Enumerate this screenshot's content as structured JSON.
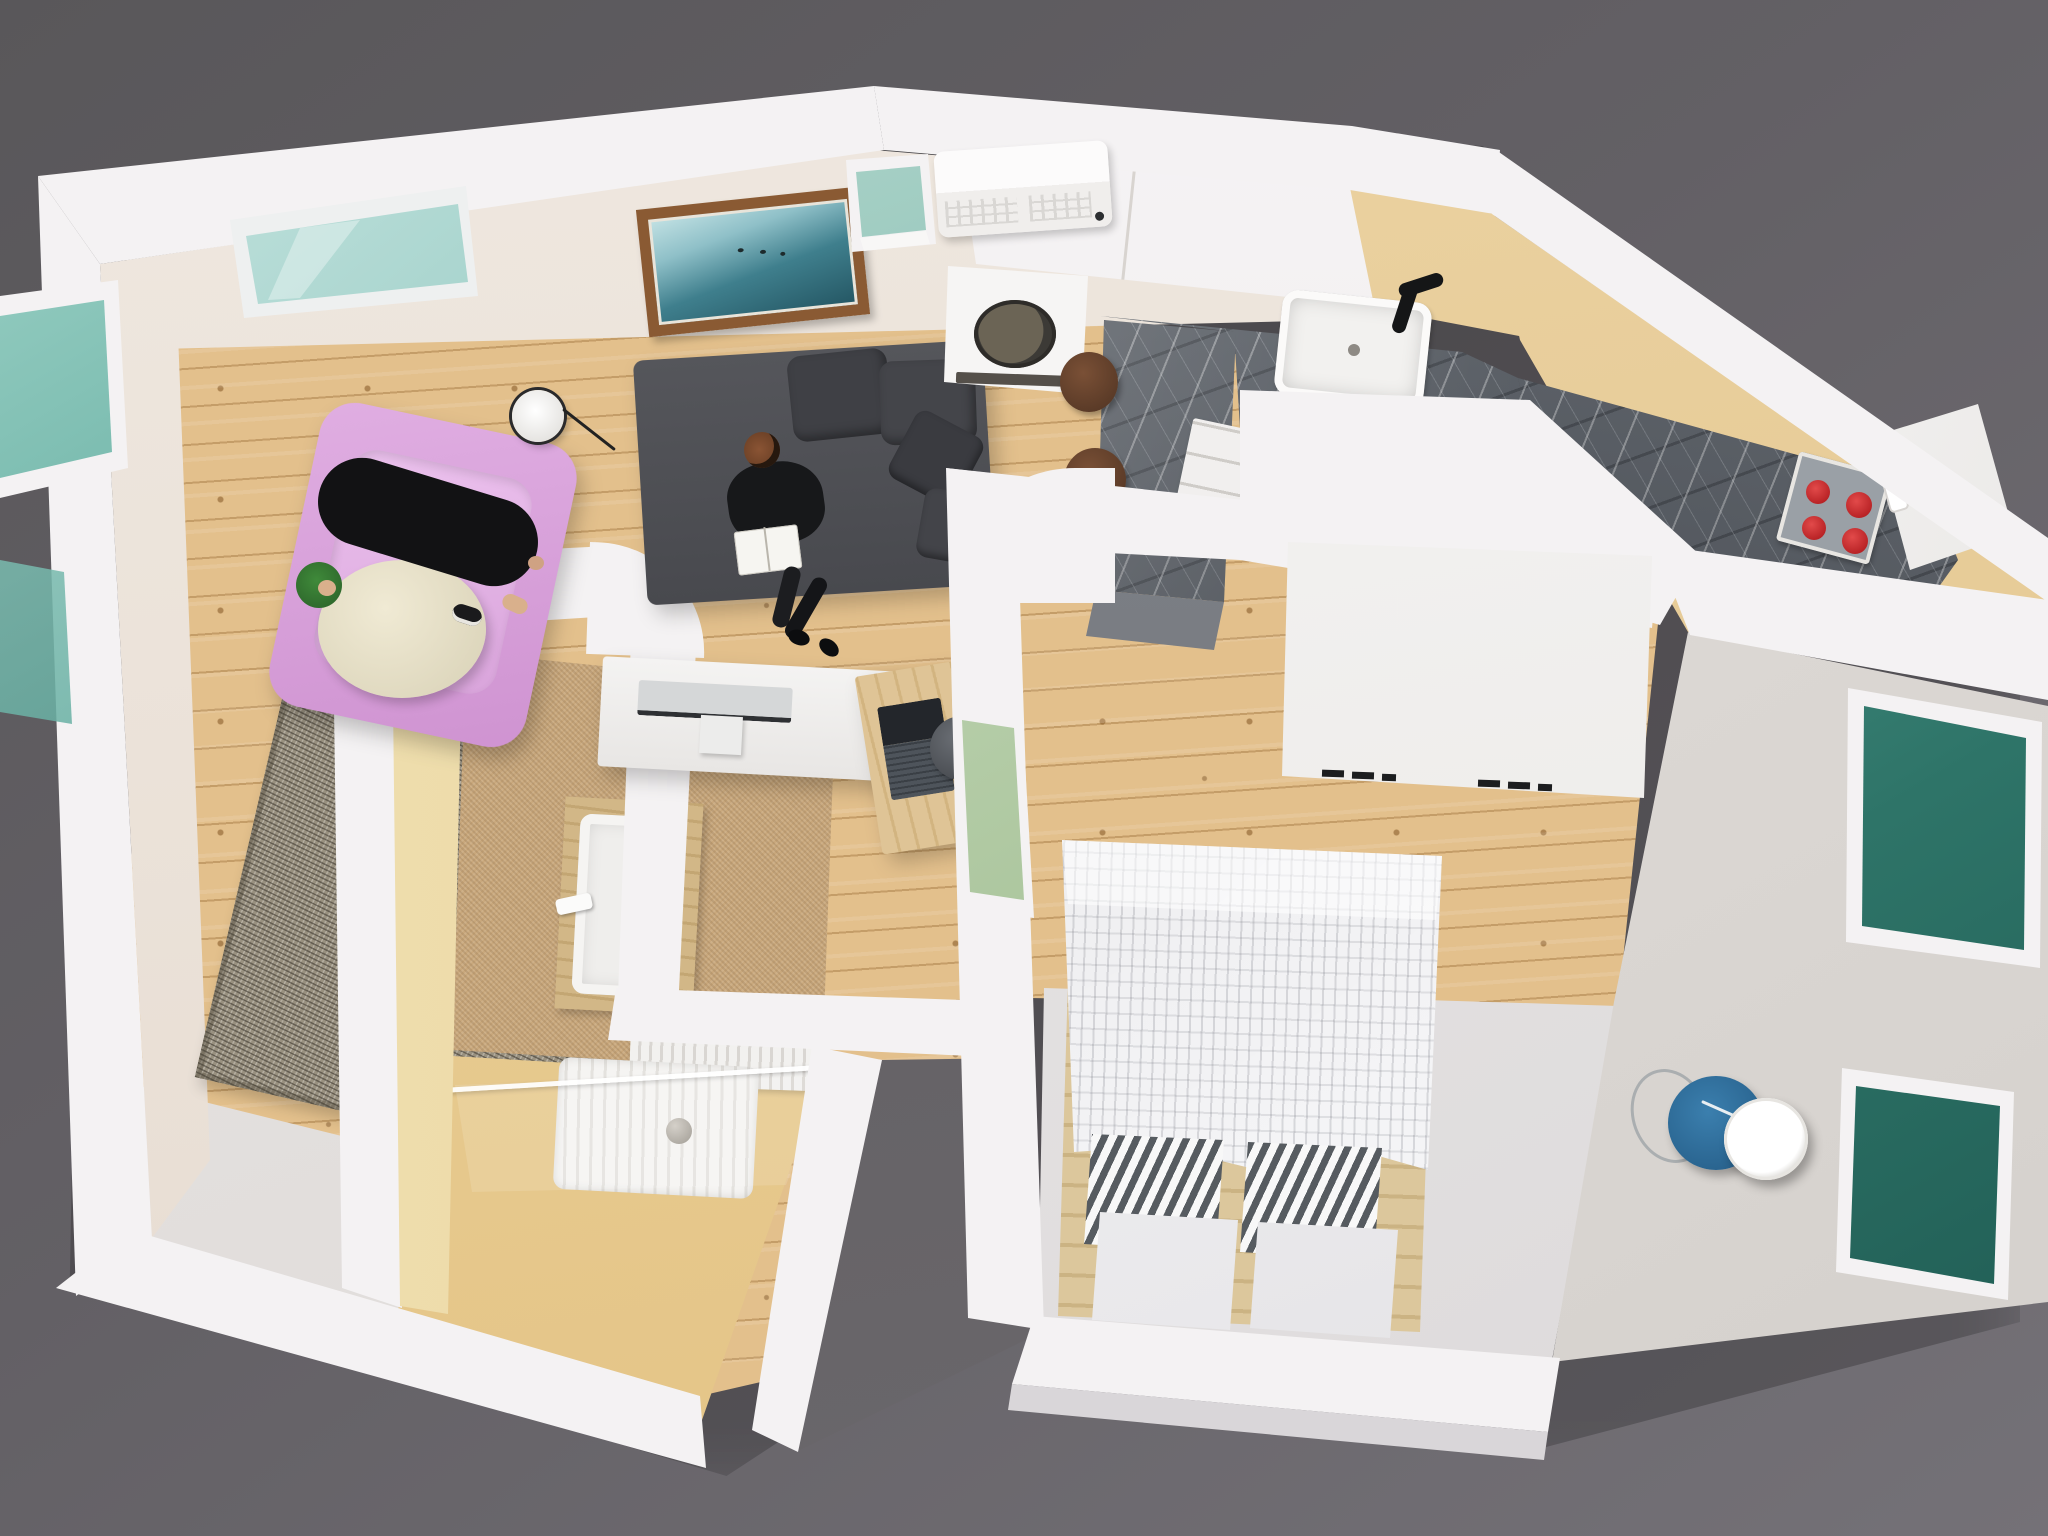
{
  "scene": {
    "type": "3d-floor-plan-render",
    "view": "top-down dollhouse cutaway",
    "description": "Photorealistic top-down 3D render of a studio apartment with living room, open kitchen, bathroom and bedroom"
  },
  "palette": {
    "background": "#636065",
    "walls": "#f4f2f3",
    "interior_wall_cream": "#ebe2d8",
    "kitchen_wall_tan": "#e7cd9c",
    "wood_floor": "#e3c08c",
    "marble_counter": "#5f646b",
    "bathroom_carpet": "#c9a87c",
    "bathroom_yellow_floor": "#e7c98f",
    "bedroom_gray_floor": "#e5e2e3",
    "window_glass": "#3b8578",
    "armchair_pink": "#d9a2db",
    "sofa_gray": "#4f5055",
    "bedside_table_blue": "#2c6c99",
    "stove_knob_red": "#cf2126"
  },
  "labels": {
    "building": "Apartment shell (white walls)",
    "living": "Living room",
    "kitchen": "Kitchen",
    "bathroom": "Bathroom",
    "bedroom": "Bedroom",
    "wood-floor": "Wooden plank floor",
    "light-floor": "Light floor (entry corner)",
    "skylight": "Skylight window",
    "picture": "Framed ocean picture",
    "window-top": "Top wall window",
    "ac-unit": "Air conditioner unit",
    "sofa": "Gray sofa",
    "sofa-person": "Person reading on sofa",
    "book": "Open book",
    "armchair": "Pink armchair",
    "armchair-person": "Person lounging in armchair",
    "pouf": "Round cream pouf",
    "floor-lamp": "Floor lamp",
    "rug": "Woven rug",
    "desk": "White desk",
    "monitor": "Computer monitor",
    "laptop-table": "Wooden laptop table",
    "laptop": "Laptop",
    "desk-stool": "Desk stool",
    "kitchen-counter": "Marble kitchen counter",
    "kitchen-counter-right": "Marble counter (right wing)",
    "kitchen-island": "Marble island peninsula",
    "upper-cabinets": "White upper cabinets",
    "range-hood": "Appliance with round plate",
    "kitchen-sink": "Kitchen sink",
    "faucet": "Black kitchen faucet",
    "cooktop": "Cooktop with red knobs",
    "fridge": "White fridge cabinet",
    "bar-stool-a": "Bar stool",
    "bar-stool-b": "Bar stool",
    "base-drawers": "Kitchen base drawers",
    "vanity": "Bathroom wooden vanity",
    "bathroom-sink": "Bathroom sink",
    "shower-tray": "Shower tray",
    "shower-glass": "Glass shower screen",
    "radiator": "Wall radiator",
    "shower-drain": "Shower drain ball",
    "yellow-floor": "Bathroom yellow floor",
    "carpet-floor": "Bathroom carpet floor",
    "bed": "Double bed on pallet base",
    "duvet": "Patterned duvet",
    "pillow-striped-a": "Striped pillow",
    "pillow-striped-b": "Striped pillow",
    "pillow-white-a": "White pillow",
    "pillow-white-b": "White pillow",
    "wardrobe": "White wardrobe (top view)",
    "bedside-table": "Blue bedside table",
    "bedside-lamp": "White cylinder lamp",
    "window-right-1": "Bedroom window (right wall)",
    "window-right-2": "Bedroom window (lower right wall)",
    "interior-window": "Interior window (bedroom/living)",
    "window-left-1": "Living room window (left wall)",
    "window-left-2": "Living room window (lower left wall)",
    "gray-floor": "Bedroom light gray floor",
    "hallway-niche": "Exterior niche between rooms"
  }
}
